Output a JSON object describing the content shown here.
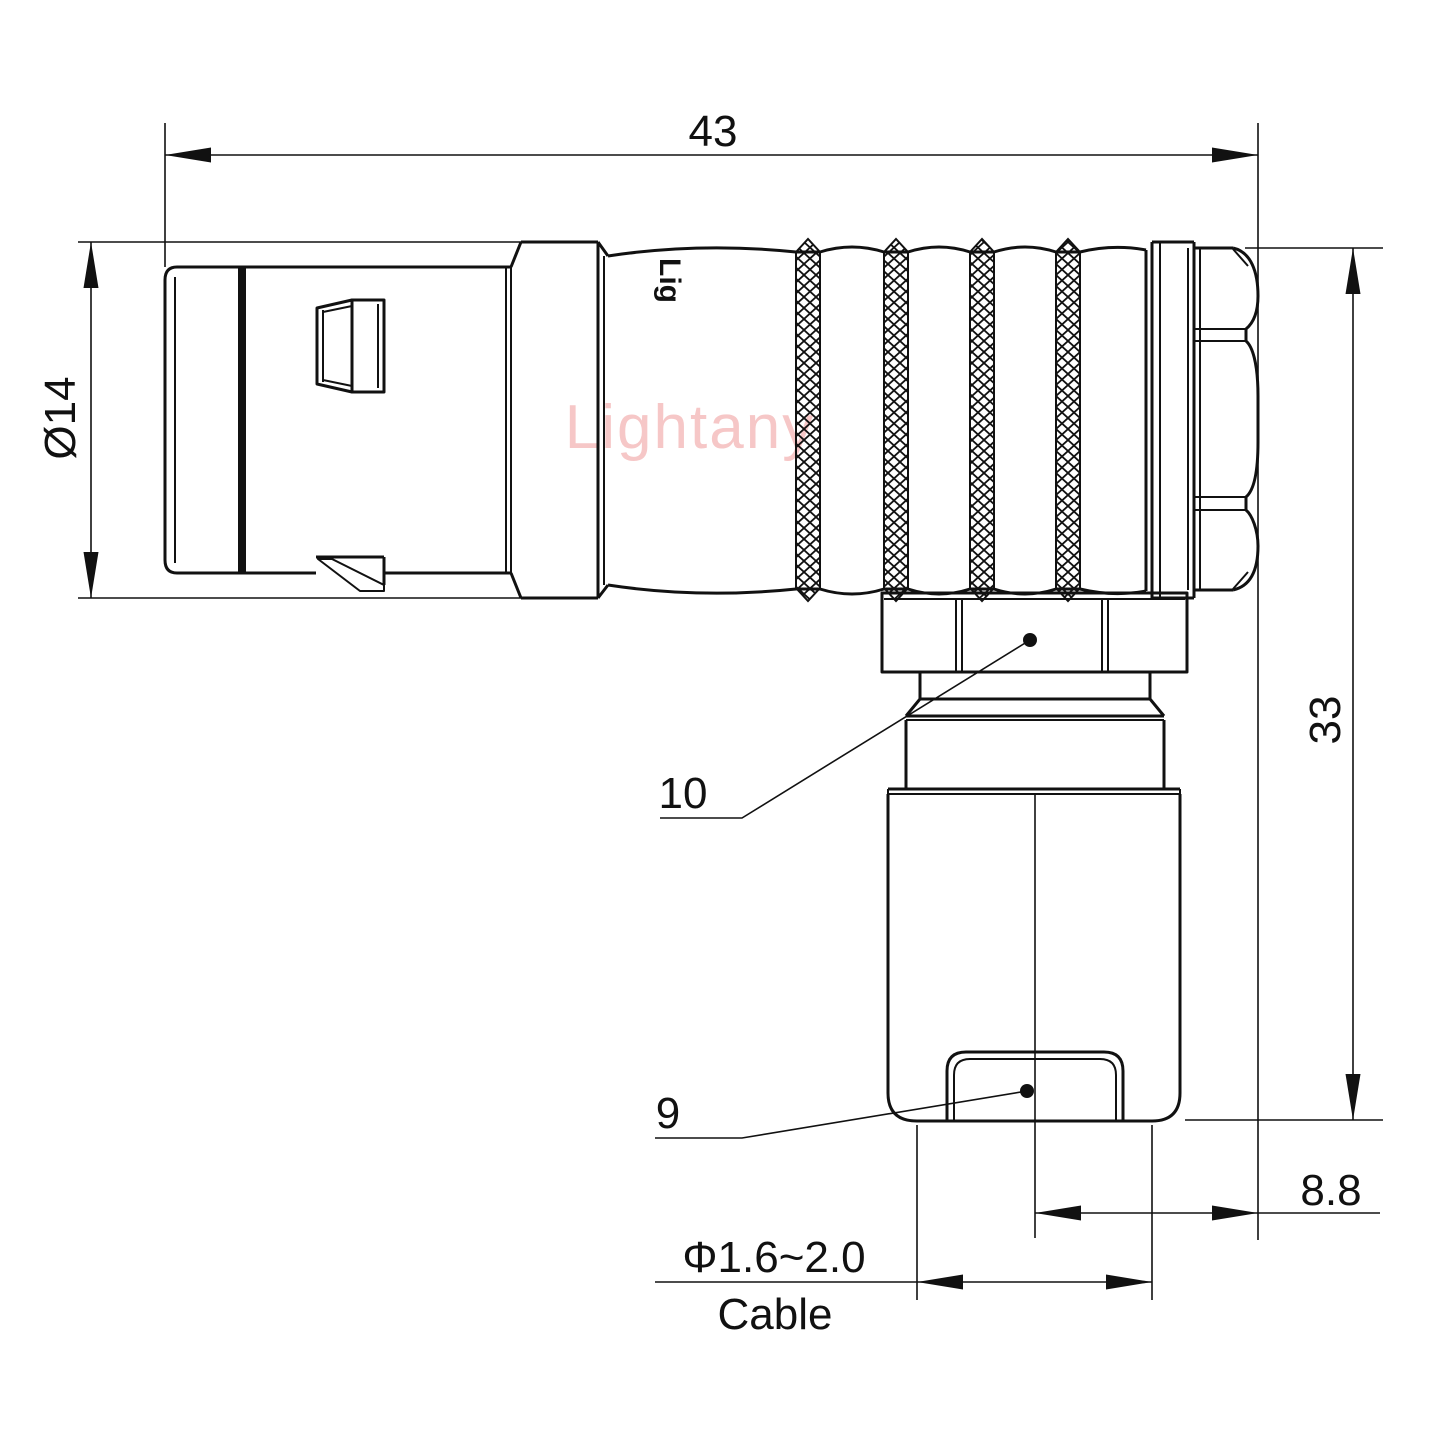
{
  "watermark": {
    "text": "Lightany",
    "color": "#ef9a9a"
  },
  "brand": {
    "marking": "Lig"
  },
  "colors": {
    "line": "#111111",
    "background": "#ffffff"
  },
  "dims": {
    "overall_length": "43",
    "front_diameter": "Ø14",
    "height": "33",
    "rear_offset": "8.8",
    "cable_range": "Φ1.6~2.0",
    "cable_label": "Cable"
  },
  "labels": {
    "coupling_nut": "10",
    "cable_clamp": "9"
  }
}
